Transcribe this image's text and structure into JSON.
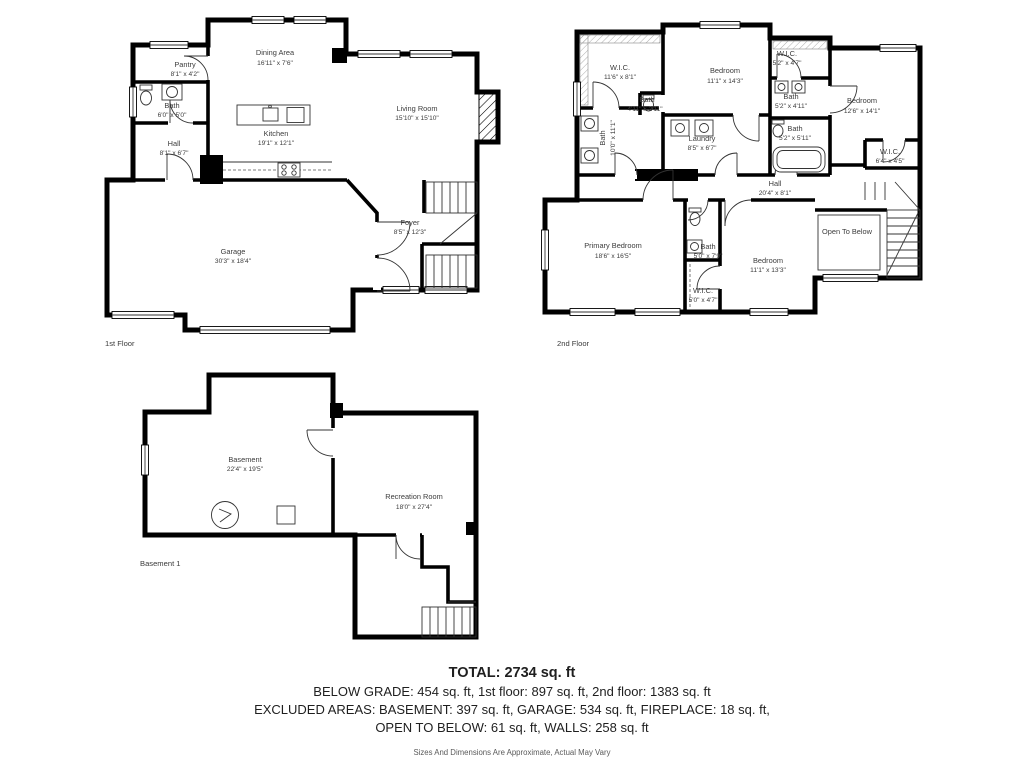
{
  "colors": {
    "wall": "#000000",
    "label_text": "#3c3c3c",
    "summary_text": "#1f1f1f",
    "disclaimer_text": "#5a5a5a",
    "background": "#ffffff"
  },
  "floors": {
    "first": {
      "floor_label": "1st Floor",
      "rooms": {
        "pantry": {
          "name": "Pantry",
          "dims": "8'1\" x 4'2\""
        },
        "bath": {
          "name": "Bath",
          "dims": "6'0\" x 5'0\""
        },
        "hall": {
          "name": "Hall",
          "dims": "8'1\" x 6'7\""
        },
        "dining": {
          "name": "Dining Area",
          "dims": "16'11\" x 7'6\""
        },
        "kitchen": {
          "name": "Kitchen",
          "dims": "19'1\" x 12'1\""
        },
        "living": {
          "name": "Living Room",
          "dims": "15'10\" x 15'10\""
        },
        "garage": {
          "name": "Garage",
          "dims": "30'3\" x 18'4\""
        },
        "foyer": {
          "name": "Foyer",
          "dims": "8'5\" x 12'3\""
        }
      }
    },
    "second": {
      "floor_label": "2nd Floor",
      "rooms": {
        "wic1": {
          "name": "W.I.C.",
          "dims": "11'6\" x 8'1\""
        },
        "bath_main": {
          "name": "Bath",
          "dims": "10'0\" x 11'1\""
        },
        "bath_small": {
          "name": "Bath",
          "dims": "4'11\" x 2'11\""
        },
        "bedroom1": {
          "name": "Bedroom",
          "dims": "11'1\" x 14'3\""
        },
        "wic2": {
          "name": "W.I.C.",
          "dims": "5'2\" x 4'7\""
        },
        "bath2": {
          "name": "Bath",
          "dims": "5'2\" x 4'11\""
        },
        "bath3": {
          "name": "Bath",
          "dims": "5'2\" x 5'11\""
        },
        "bedroom2": {
          "name": "Bedroom",
          "dims": "12'6\" x 14'1\""
        },
        "wic3": {
          "name": "W.I.C.",
          "dims": "6'4\" x 4'5\""
        },
        "laundry": {
          "name": "Laundry",
          "dims": "8'5\" x 6'7\""
        },
        "hall": {
          "name": "Hall",
          "dims": "20'4\" x 8'1\""
        },
        "primary": {
          "name": "Primary Bedroom",
          "dims": "18'6\" x 16'5\""
        },
        "bath4": {
          "name": "Bath",
          "dims": "5'0\" x 7'9\""
        },
        "bedroom3": {
          "name": "Bedroom",
          "dims": "11'1\" x 13'3\""
        },
        "wic4": {
          "name": "W.I.C.",
          "dims": "5'0\" x 4'7\""
        },
        "open_to_below": {
          "name": "Open To Below"
        }
      }
    },
    "basement": {
      "floor_label": "Basement 1",
      "rooms": {
        "basement": {
          "name": "Basement",
          "dims": "22'4\" x 19'5\""
        },
        "recreation": {
          "name": "Recreation Room",
          "dims": "18'0\" x 27'4\""
        }
      }
    }
  },
  "summary": {
    "total": "TOTAL: 2734 sq. ft",
    "line1": "BELOW GRADE: 454 sq. ft, 1st floor: 897 sq. ft, 2nd floor: 1383 sq. ft",
    "line2": "EXCLUDED AREAS: BASEMENT: 397 sq. ft, GARAGE: 534 sq. ft, FIREPLACE: 18 sq. ft,",
    "line3": "OPEN TO BELOW: 61 sq. ft, WALLS: 258 sq. ft",
    "disclaimer": "Sizes And Dimensions Are Approximate, Actual May Vary"
  }
}
